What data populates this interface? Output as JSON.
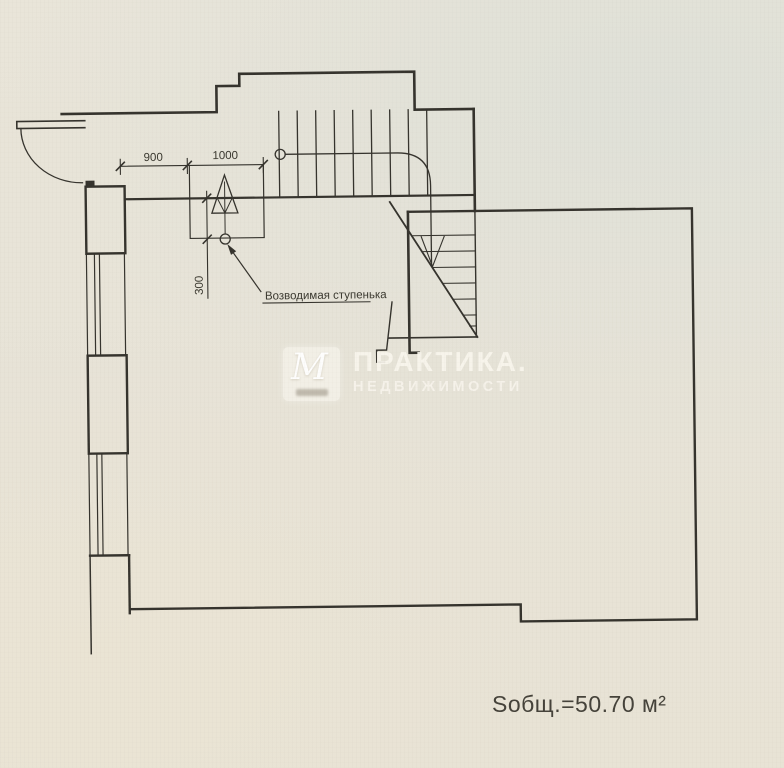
{
  "labels": {
    "dim_900": "900",
    "dim_1000": "1000",
    "dim_300": "300",
    "step_note": "Возводимая ступенька",
    "total_area": "Sобщ.=50.70 м²"
  },
  "watermark": {
    "brand": "ПРАКТИКА.",
    "brand_sub": "НЕДВИЖИМОСТИ",
    "logo_letter": "М"
  },
  "colors": {
    "paper": "#e8e4d8",
    "ink": "#35332d",
    "watermark_text": "#f4f1e8"
  }
}
